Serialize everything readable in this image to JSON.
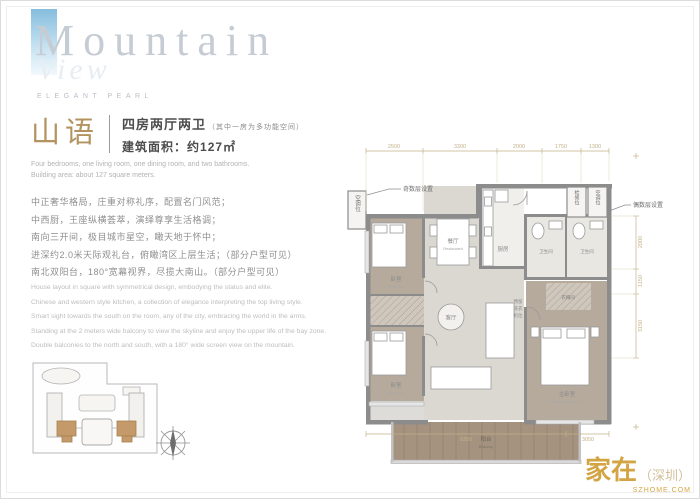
{
  "colors": {
    "accent_gold": "#b3935f",
    "dim_gold": "#c5b189",
    "wall_gray": "#8c8c8c",
    "unit_tan": "#c59a6b",
    "brand_blue": "#85bcdd"
  },
  "brand": {
    "title": "Mountain",
    "overlay": "View",
    "subtitle": "ELEGANT PEARL"
  },
  "header": {
    "name_cn": "山语",
    "type_cn": "四房两厅两卫",
    "type_note": "（其中一房为多功能空间）",
    "area_cn": "建筑面积：约127㎡",
    "type_en": "Four bedrooms, one living room, one dining room, and two bathrooms.",
    "area_en": "Building area: about 127 square meters."
  },
  "description_cn": {
    "line1": "中正奢华格局，庄重对称礼序，配置名门风范；",
    "line2": "中西厨，王座纵横荟萃，演绎尊享生活格调；",
    "line3": "南向三开间，极目城市星空，瞰天地于怀中；",
    "line4": "进深约2.0米天际观礼台，俯瞰湾区上层生活；（部分户型可见）",
    "line5": "南北双阳台，180°宽幕视界，尽揽大南山。（部分户型可见）"
  },
  "description_en": {
    "line1": "House layout in square with symmetrical design, embodying the status and elite.",
    "line2": "Chinese and western style kitchen, a collection of elegance interpreting the top living style.",
    "line3": "Smart sight towards the south on the room, any of the city, embracing the world in the arms.",
    "line4": "Standing at the 2 meters wide balcony to view the skyline and enjoy the upper life of the bay zone.",
    "line5": "Double balconies to the north and south, with a 180° wide screen view on the mountain."
  },
  "floorplan": {
    "dims_top": [
      "2500",
      "3300",
      "2000",
      "1750",
      "1300"
    ],
    "dims_right": [
      "2000",
      "1150",
      "3150"
    ],
    "dims_bottom": [
      "9350",
      "3050"
    ],
    "callout_left": "奇数层设置",
    "callout_left_box": "空调位",
    "callout_right": "偶数层设置",
    "callout_right_box1": "检修位",
    "callout_right_box2": "空调位",
    "rooms": {
      "bedroom1_cn": "卧室",
      "bedroom1_en": "Bedroom",
      "bedroom2_cn": "卧室",
      "bedroom2_en": "Bedroom",
      "dining_cn": "餐厅",
      "dining_en": "Restaurant",
      "living_cn": "客厅",
      "kitchen_cn": "厨房",
      "bath1_cn": "卫生间",
      "bath2_cn": "卫生间",
      "closet_cn": "衣帽间",
      "master_cn": "主卧室",
      "master_en": "Master bedroom",
      "balcony_cn": "阳台",
      "balcony_en": "Balcony",
      "laundry1": "预留",
      "laundry2": "洗衣",
      "laundry3": "机位"
    }
  },
  "watermark": {
    "main": "家在",
    "paren": "（深圳）",
    "sub": "SZHOME.COM"
  }
}
